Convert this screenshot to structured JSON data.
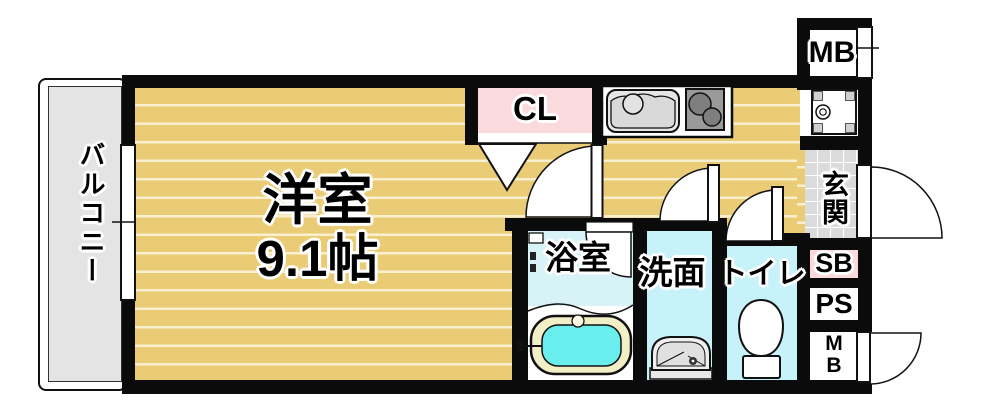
{
  "rooms": {
    "balcony": "バルコニー",
    "main_room_name": "洋室",
    "main_room_size": "9.1帖",
    "closet": "CL",
    "meter_box_top": "MB",
    "entrance": "玄関",
    "shoe_box": "SB",
    "pipe_space": "PS",
    "meter_box_bottom_line1": "M",
    "meter_box_bottom_line2": "B",
    "bathroom": "浴室",
    "washroom": "洗面",
    "toilet": "トイレ"
  },
  "colors": {
    "wall": "#0b0b0b",
    "flooring": "#EACB76",
    "flooring_stripe": "#F8F0CE",
    "closet_pink": "#FBDADE",
    "bathroom_floor": "#D8F3F7",
    "wet_room_floor": "#C7F2FA",
    "bathtub_water": "#69EDED",
    "bathtub_rim": "#F2EEC6",
    "entrance_tile": "#DBDBDB",
    "balcony_gray": "#E4E4E4"
  }
}
